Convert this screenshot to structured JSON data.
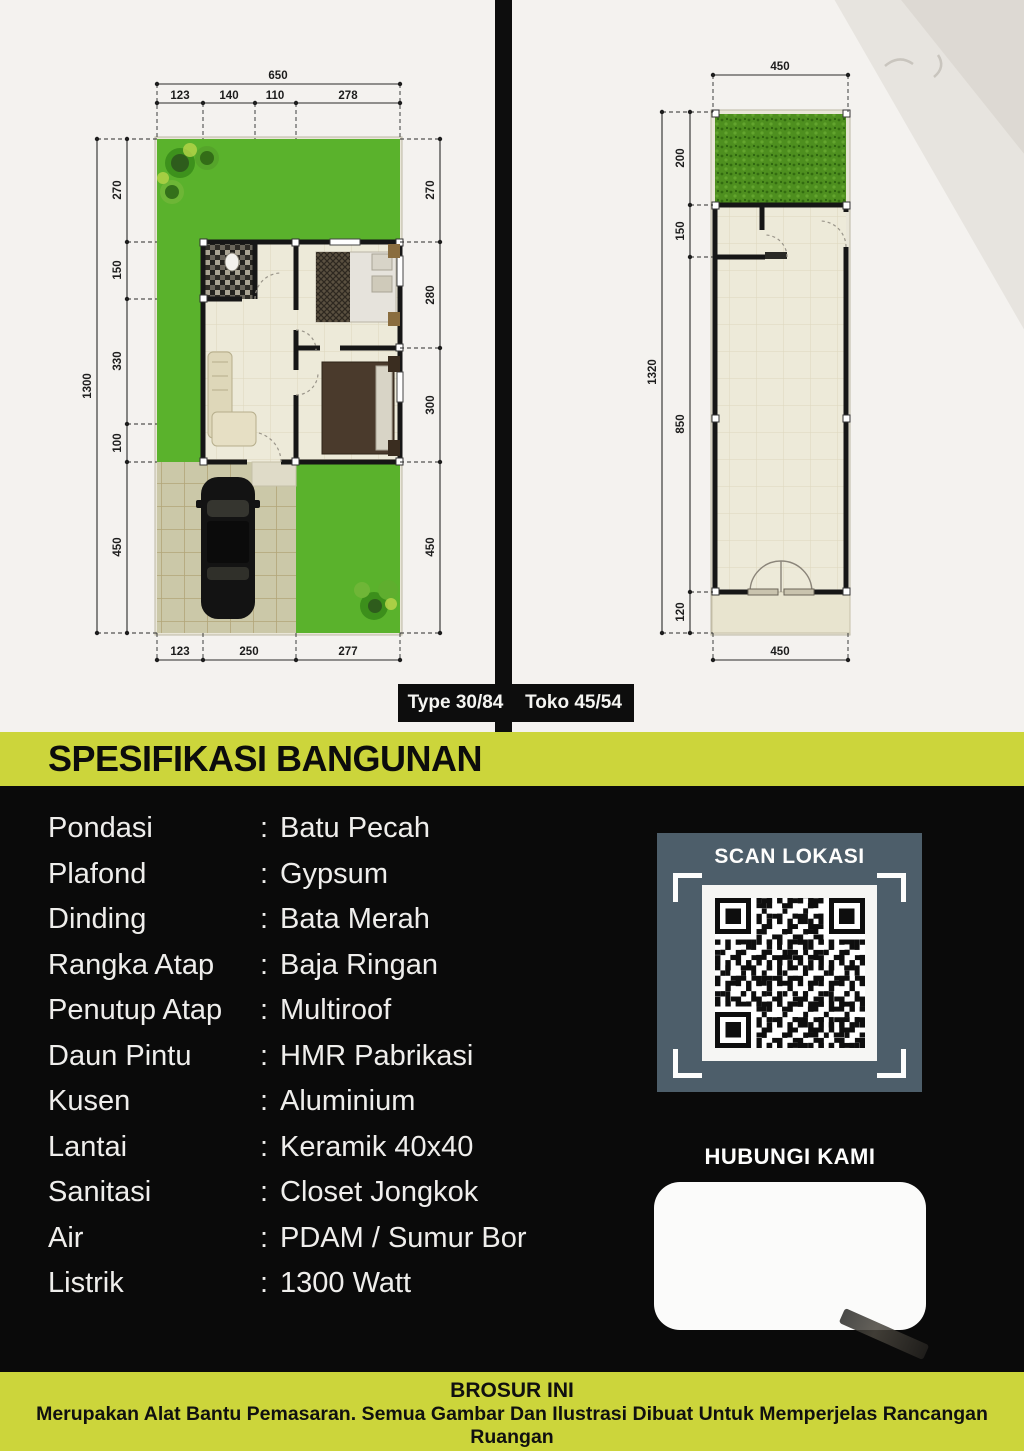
{
  "colors": {
    "accent_yellow": "#ccd53b",
    "qr_panel_blue": "#4d5e6a",
    "grass_green": "#5ab22c",
    "background_black": "#0a0a0a"
  },
  "plans": {
    "plan1": {
      "badge": "Type 30/84",
      "dims": {
        "top_total": "650",
        "top_segments": [
          "123",
          "140",
          "110",
          "278"
        ],
        "left_total": "1300",
        "left_segments": [
          "270",
          "150",
          "330",
          "100",
          "450"
        ],
        "right_segments": [
          "270",
          "280",
          "300",
          "450"
        ],
        "bottom_segments": [
          "123",
          "250",
          "277"
        ]
      }
    },
    "plan2": {
      "badge": "Toko 45/54",
      "dims": {
        "top_total": "450",
        "left_total": "1320",
        "left_segments": [
          "200",
          "150",
          "850",
          "120"
        ],
        "bottom_total": "450"
      }
    }
  },
  "spec": {
    "title": "SPESIFIKASI BANGUNAN",
    "separator": ":",
    "items": [
      {
        "label": "Pondasi",
        "value": "Batu Pecah"
      },
      {
        "label": "Plafond",
        "value": "Gypsum"
      },
      {
        "label": "Dinding",
        "value": "Bata Merah"
      },
      {
        "label": "Rangka Atap",
        "value": "Baja Ringan"
      },
      {
        "label": "Penutup Atap",
        "value": "Multiroof"
      },
      {
        "label": "Daun Pintu",
        "value": "HMR Pabrikasi"
      },
      {
        "label": "Kusen",
        "value": "Aluminium"
      },
      {
        "label": "Lantai",
        "value": "Keramik 40x40"
      },
      {
        "label": "Sanitasi",
        "value": "Closet Jongkok"
      },
      {
        "label": "Air",
        "value": "PDAM / Sumur Bor"
      },
      {
        "label": "Listrik",
        "value": "1300 Watt"
      }
    ]
  },
  "qr": {
    "title": "SCAN LOKASI"
  },
  "contact": {
    "title": "HUBUNGI KAMI"
  },
  "footer": {
    "title": "BROSUR INI",
    "line1": "Merupakan Alat Bantu Pemasaran. Semua Gambar Dan Ilustrasi Dibuat Untuk Memperjelas Rancangan Ruangan",
    "line2": "Serta Tujuan Artistik. Spesifikasi Desain Sewaktu-waktu Dapat Berubah Sesuai Kondisi Lapangan"
  }
}
